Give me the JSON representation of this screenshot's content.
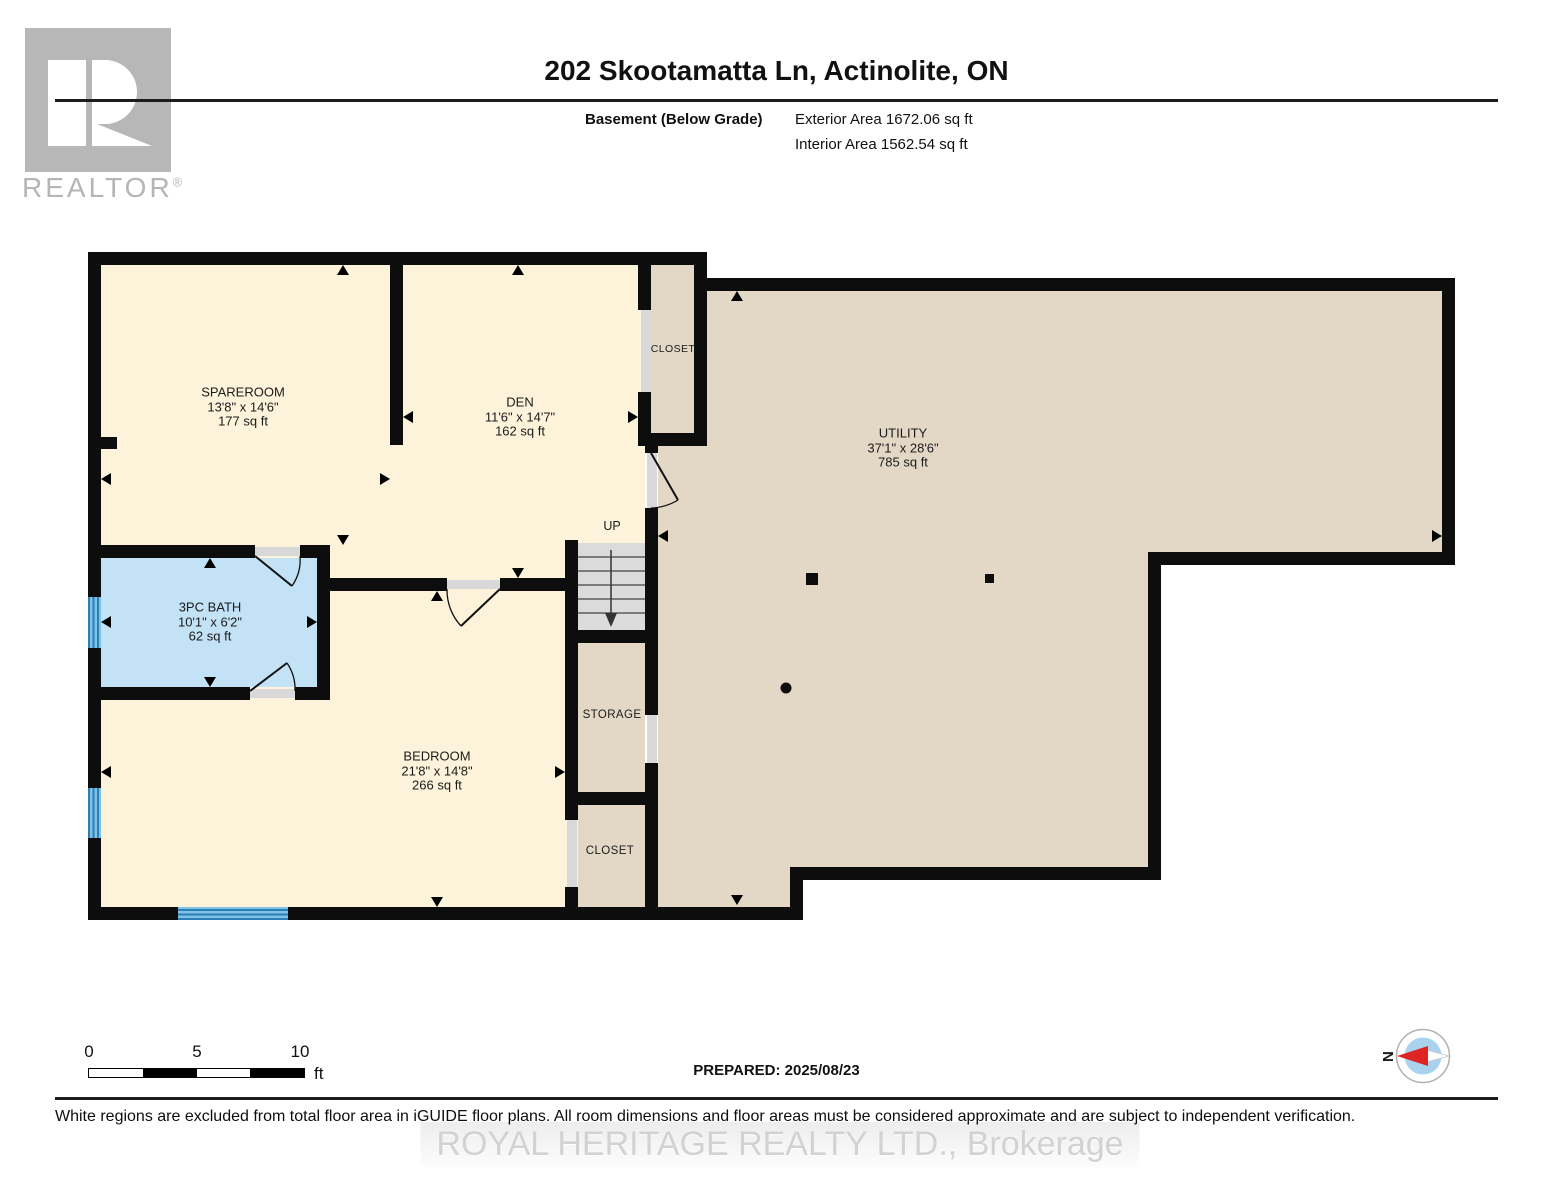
{
  "logo": {
    "realtor": "REALTOR",
    "registered_mark": "®"
  },
  "header": {
    "title": "202 Skootamatta Ln, Actinolite, ON",
    "floor_label": "Basement (Below Grade)",
    "exterior_area": "Exterior Area 1672.06 sq ft",
    "interior_area": "Interior Area 1562.54 sq ft"
  },
  "rooms": {
    "spareroom": {
      "name": "SPAREROOM",
      "dims": "13'8\" x 14'6\"",
      "area": "177 sq ft"
    },
    "den": {
      "name": "DEN",
      "dims": "11'6\" x 14'7\"",
      "area": "162 sq ft"
    },
    "utility": {
      "name": "UTILITY",
      "dims": "37'1\" x 28'6\"",
      "area": "785 sq ft"
    },
    "bath": {
      "name": "3PC BATH",
      "dims": "10'1\" x 6'2\"",
      "area": "62 sq ft"
    },
    "bedroom": {
      "name": "BEDROOM",
      "dims": "21'8\" x 14'8\"",
      "area": "266 sq ft"
    },
    "closet_top": {
      "name": "CLOSET"
    },
    "storage": {
      "name": "STORAGE"
    },
    "closet_bottom": {
      "name": "CLOSET"
    },
    "stairs": {
      "label": "UP"
    }
  },
  "footer": {
    "scale": {
      "zero": "0",
      "five": "5",
      "ten": "10",
      "unit": "ft"
    },
    "prepared": "PREPARED: 2025/08/23",
    "compass_north": "N",
    "disclaimer": "White regions are excluded from total floor area in iGUIDE floor plans. All room dimensions and floor areas must be considered approximate and are subject to independent verification.",
    "watermark": "ROYAL HERITAGE REALTY LTD., Brokerage"
  },
  "colors": {
    "cream": "#FCF3DA",
    "tan": "#E3D8C5",
    "bath_blue": "#C3E2F6",
    "stair_gray": "#DBDBDB",
    "wall": "#0D0D0D",
    "window_blue": "#2D7DB6",
    "compass_red": "#E02423",
    "compass_blue": "#A9D2EE"
  }
}
